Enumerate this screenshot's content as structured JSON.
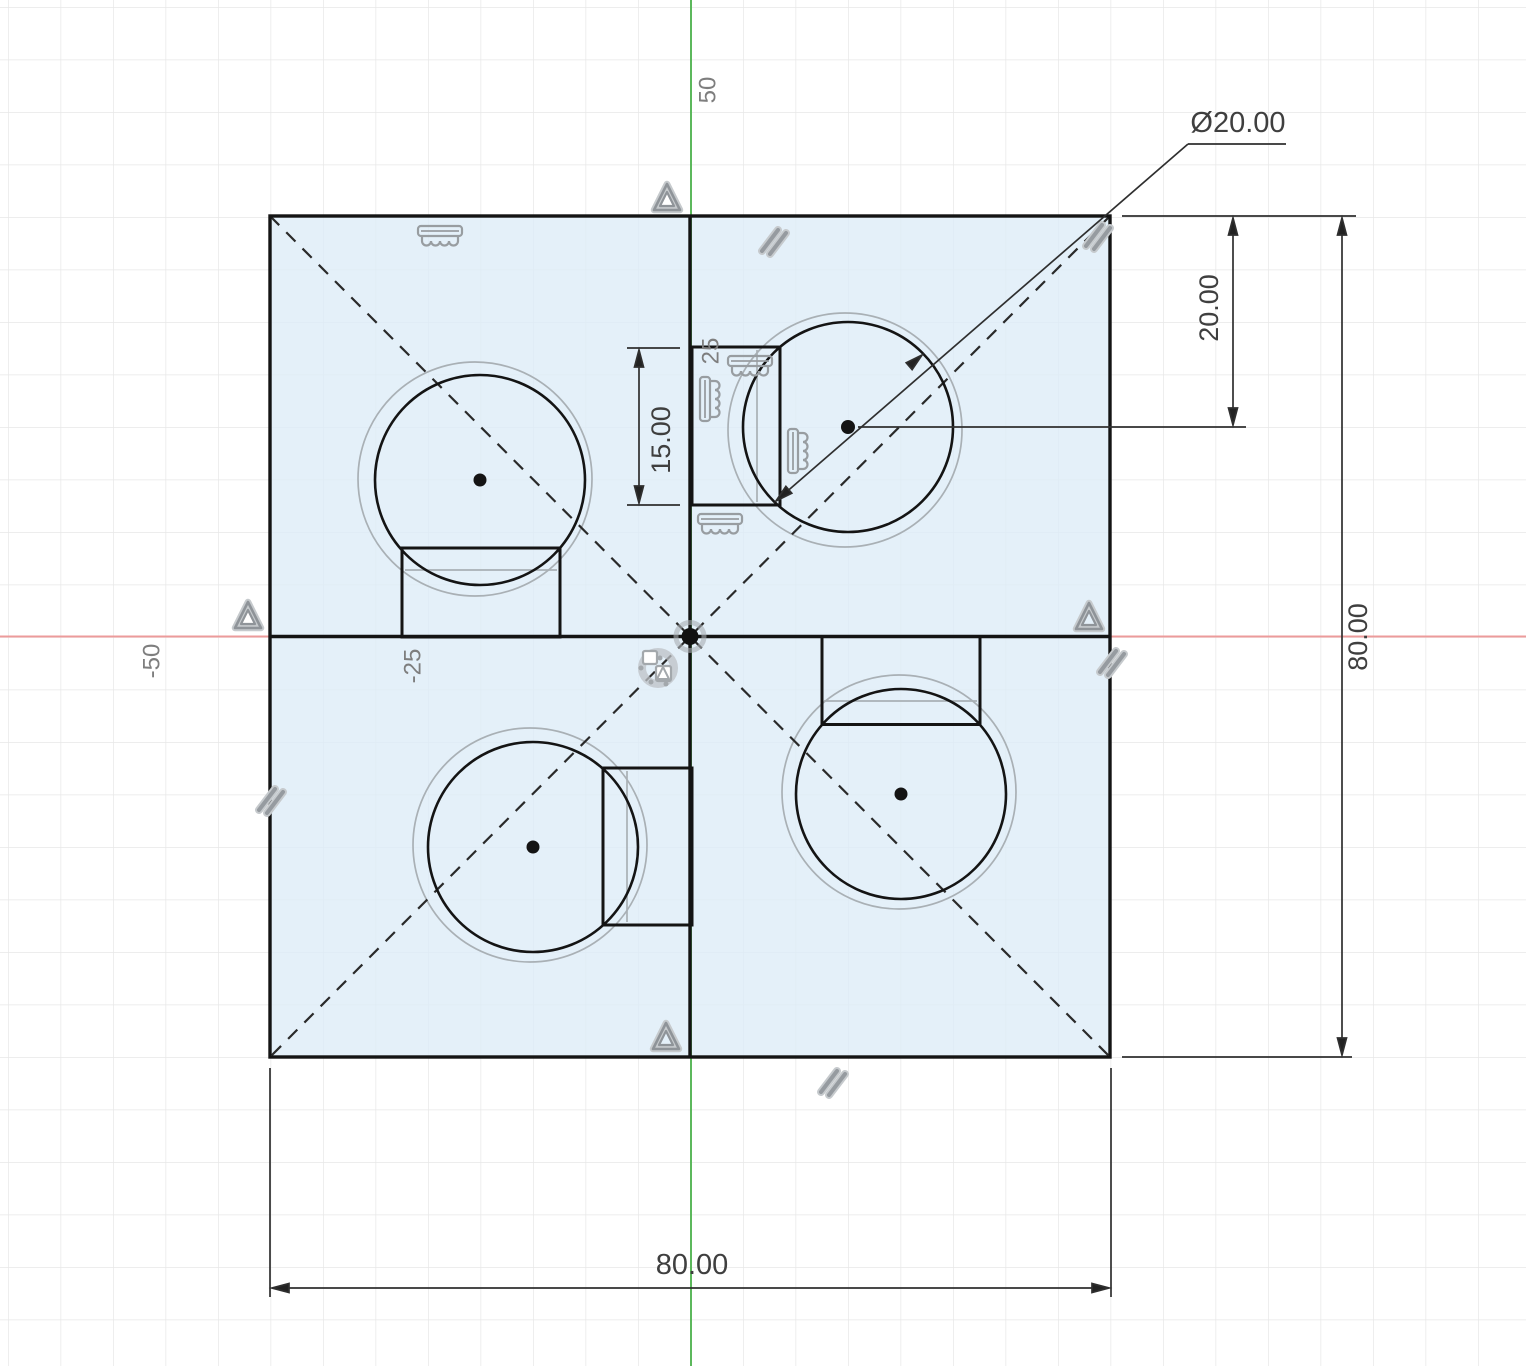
{
  "app": {
    "view": "cad-sketch-canvas"
  },
  "dimensions": {
    "circle_diameter": "Ø20.00",
    "center_offset_vertical": "20.00",
    "square_height": "80.00",
    "tab_length": "15.00",
    "square_width": "80.00"
  },
  "grid_labels": {
    "y_50": "50",
    "y_25": "25",
    "x_neg_50": "-50",
    "x_neg_25": "-25"
  },
  "icons": {
    "midpoint_constraint": "triangle-outline",
    "parallel_constraint": "double-slash",
    "fix_constraint": "comb-hatch",
    "coincident_cluster": "dot-square-cluster",
    "origin_point": "filled-dot"
  },
  "colors": {
    "axis_vertical": "#5cb85c",
    "axis_horizontal": "#ec9b9b",
    "sketch_fill": "#e8f2f9",
    "geometry": "#141414",
    "ghost_geometry": "#a9b0b5",
    "constraint_icon": "#989da1",
    "dimension": "#2f2f2f",
    "grid_line": "#e7e7e7"
  }
}
